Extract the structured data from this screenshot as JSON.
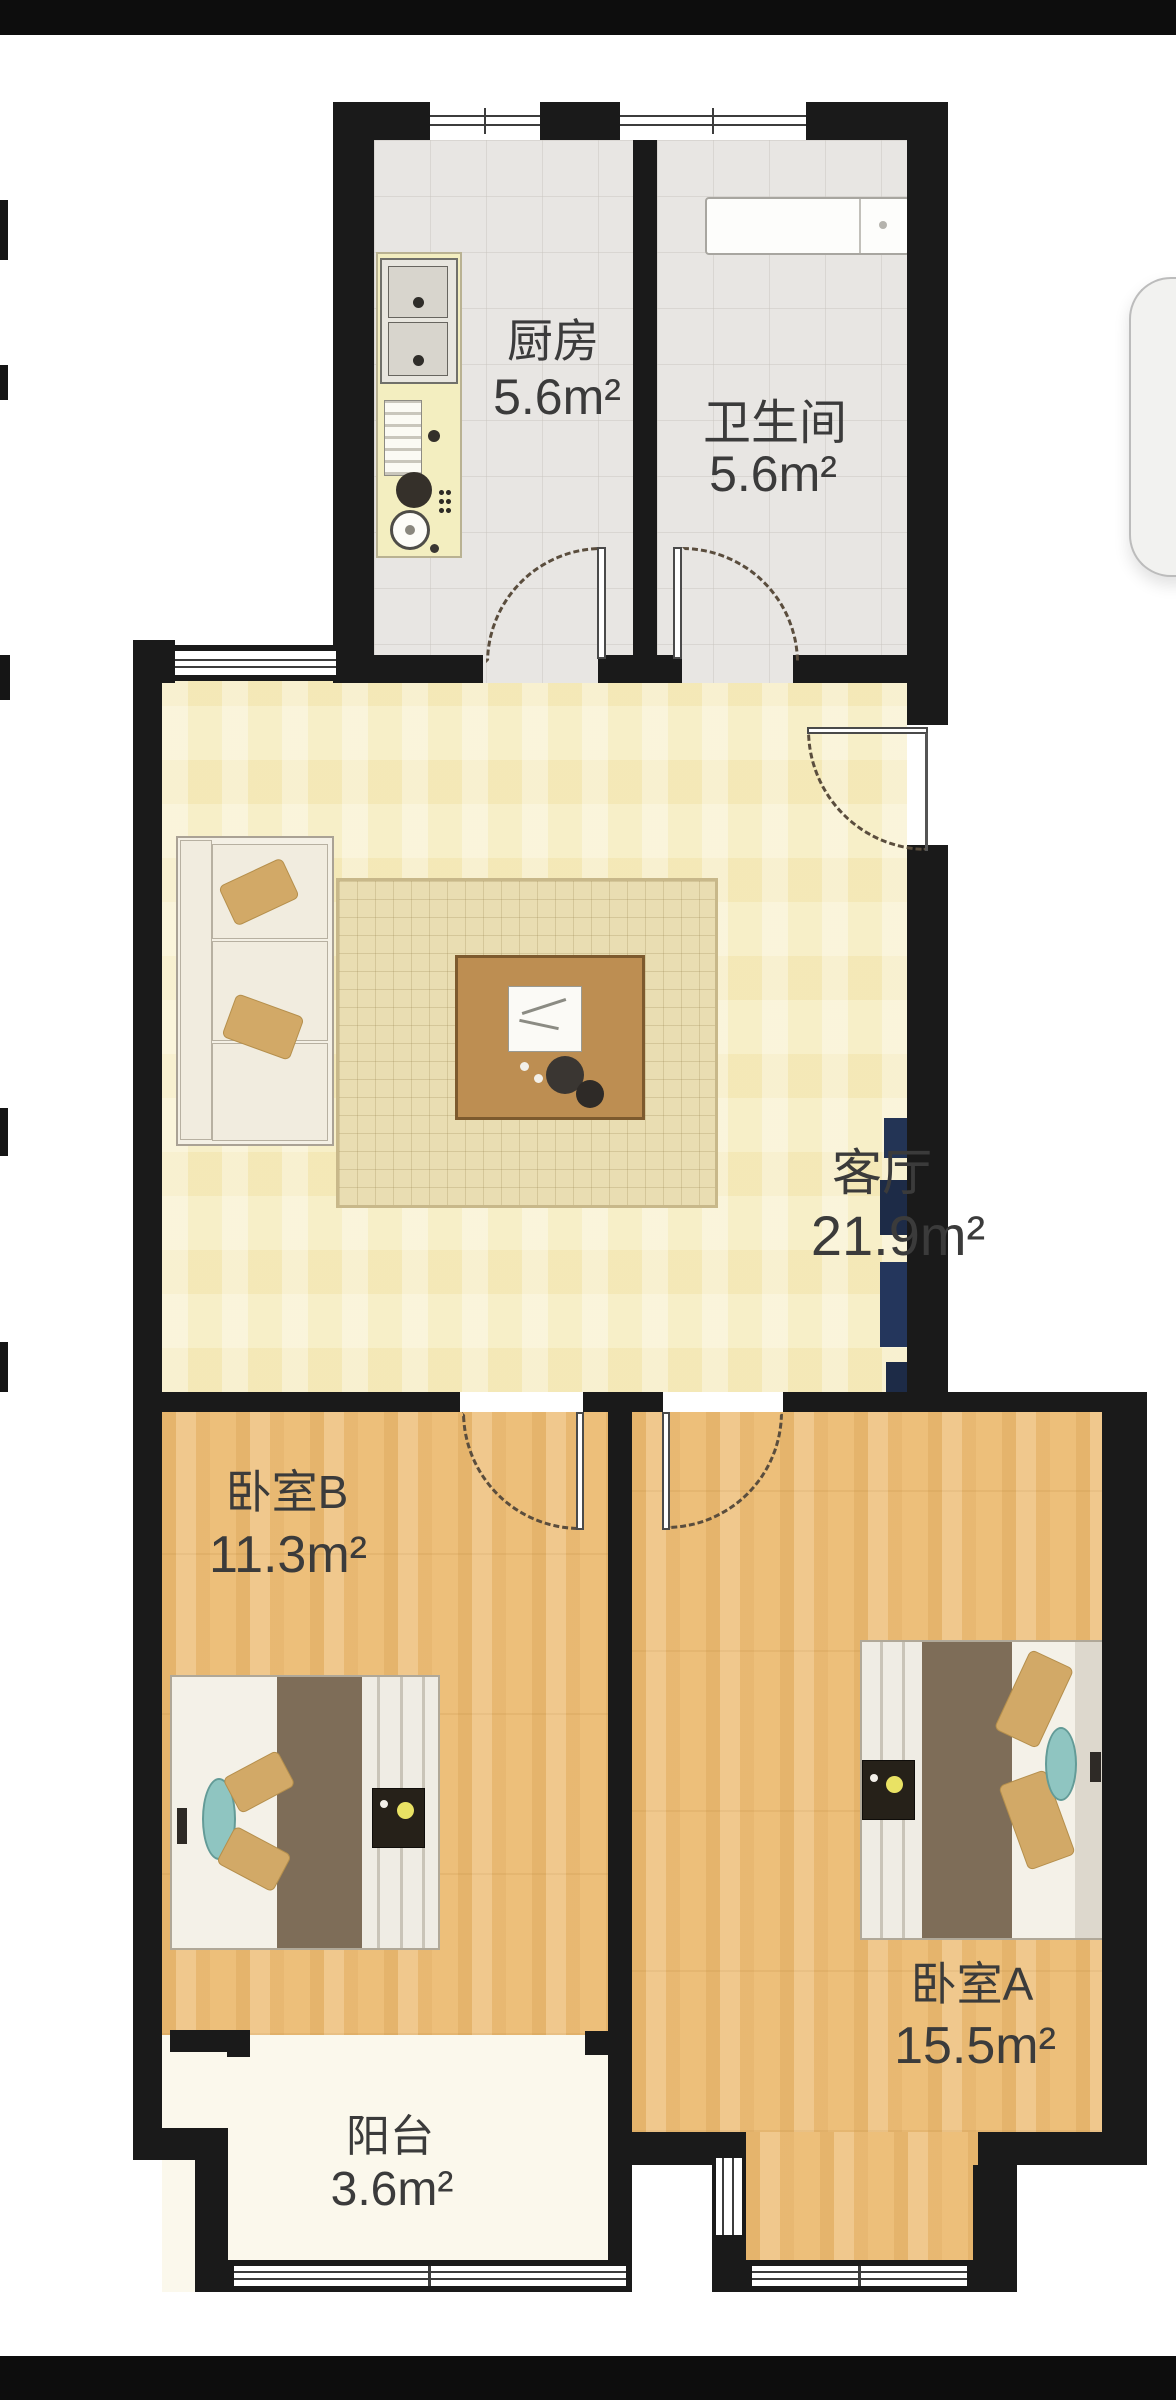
{
  "plan_title": "2-bedroom apartment floor plan",
  "rooms": [
    {
      "id": "kitchen",
      "name": "厨房",
      "area": "5.6m²"
    },
    {
      "id": "bathroom",
      "name": "卫生间",
      "area": "5.6m²"
    },
    {
      "id": "living",
      "name": "客厅",
      "area": "21.9m²"
    },
    {
      "id": "bedroomB",
      "name": "卧室B",
      "area": "11.3m²"
    },
    {
      "id": "bedroomA",
      "name": "卧室A",
      "area": "15.5m²"
    },
    {
      "id": "balcony",
      "name": "阳台",
      "area": "3.6m²"
    }
  ],
  "colors": {
    "wall": "#1a1a1a",
    "living_floor": "#f7efc8",
    "wood_floor": "#edbf7a",
    "tile_floor": "#e8e6e3",
    "balcony_floor": "#fbf8ec",
    "counter": "#f3eec0",
    "blanket": "#7e6d58",
    "pillow": "#d2a967",
    "teal_cushion": "#8fc5c1",
    "lamp": "#e9e264",
    "navy_furniture": "#24365c",
    "letterbox_bar": "#0d0d0d"
  }
}
